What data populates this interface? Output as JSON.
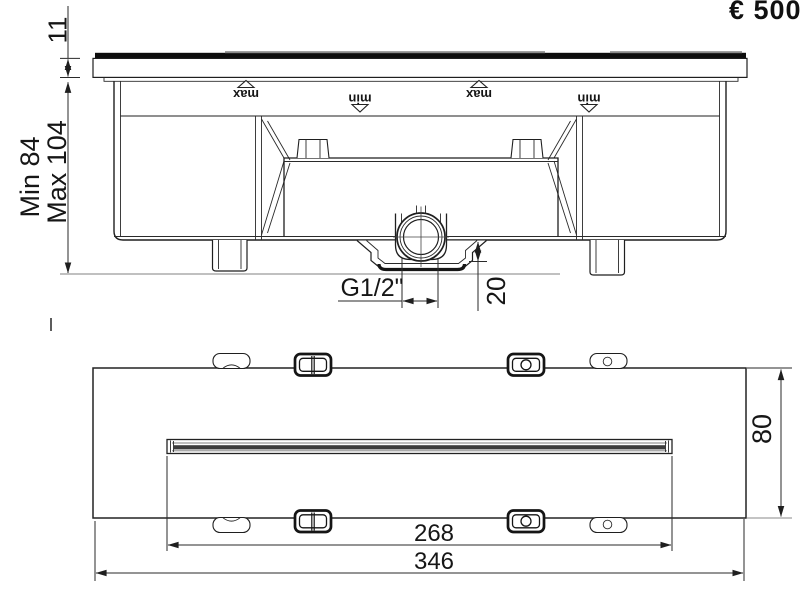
{
  "price_label": "€ 500",
  "section_view": {
    "dim_front_plate": "11",
    "dim_depth_min": "Min 84",
    "dim_depth_max": "Max 104",
    "thread_label": "G1/2\"",
    "dim_inlet_offset": "20",
    "level_markers": {
      "max": "max",
      "min": "min"
    }
  },
  "plan_view": {
    "dim_spout_slot": "268",
    "dim_overall_width": "346",
    "dim_overall_depth": "80"
  },
  "colors": {
    "line": "#1f1f1f",
    "dark_fill": "#0d0d0d",
    "stripe": "#3c3c3c",
    "gray": "#9a9a9a"
  }
}
